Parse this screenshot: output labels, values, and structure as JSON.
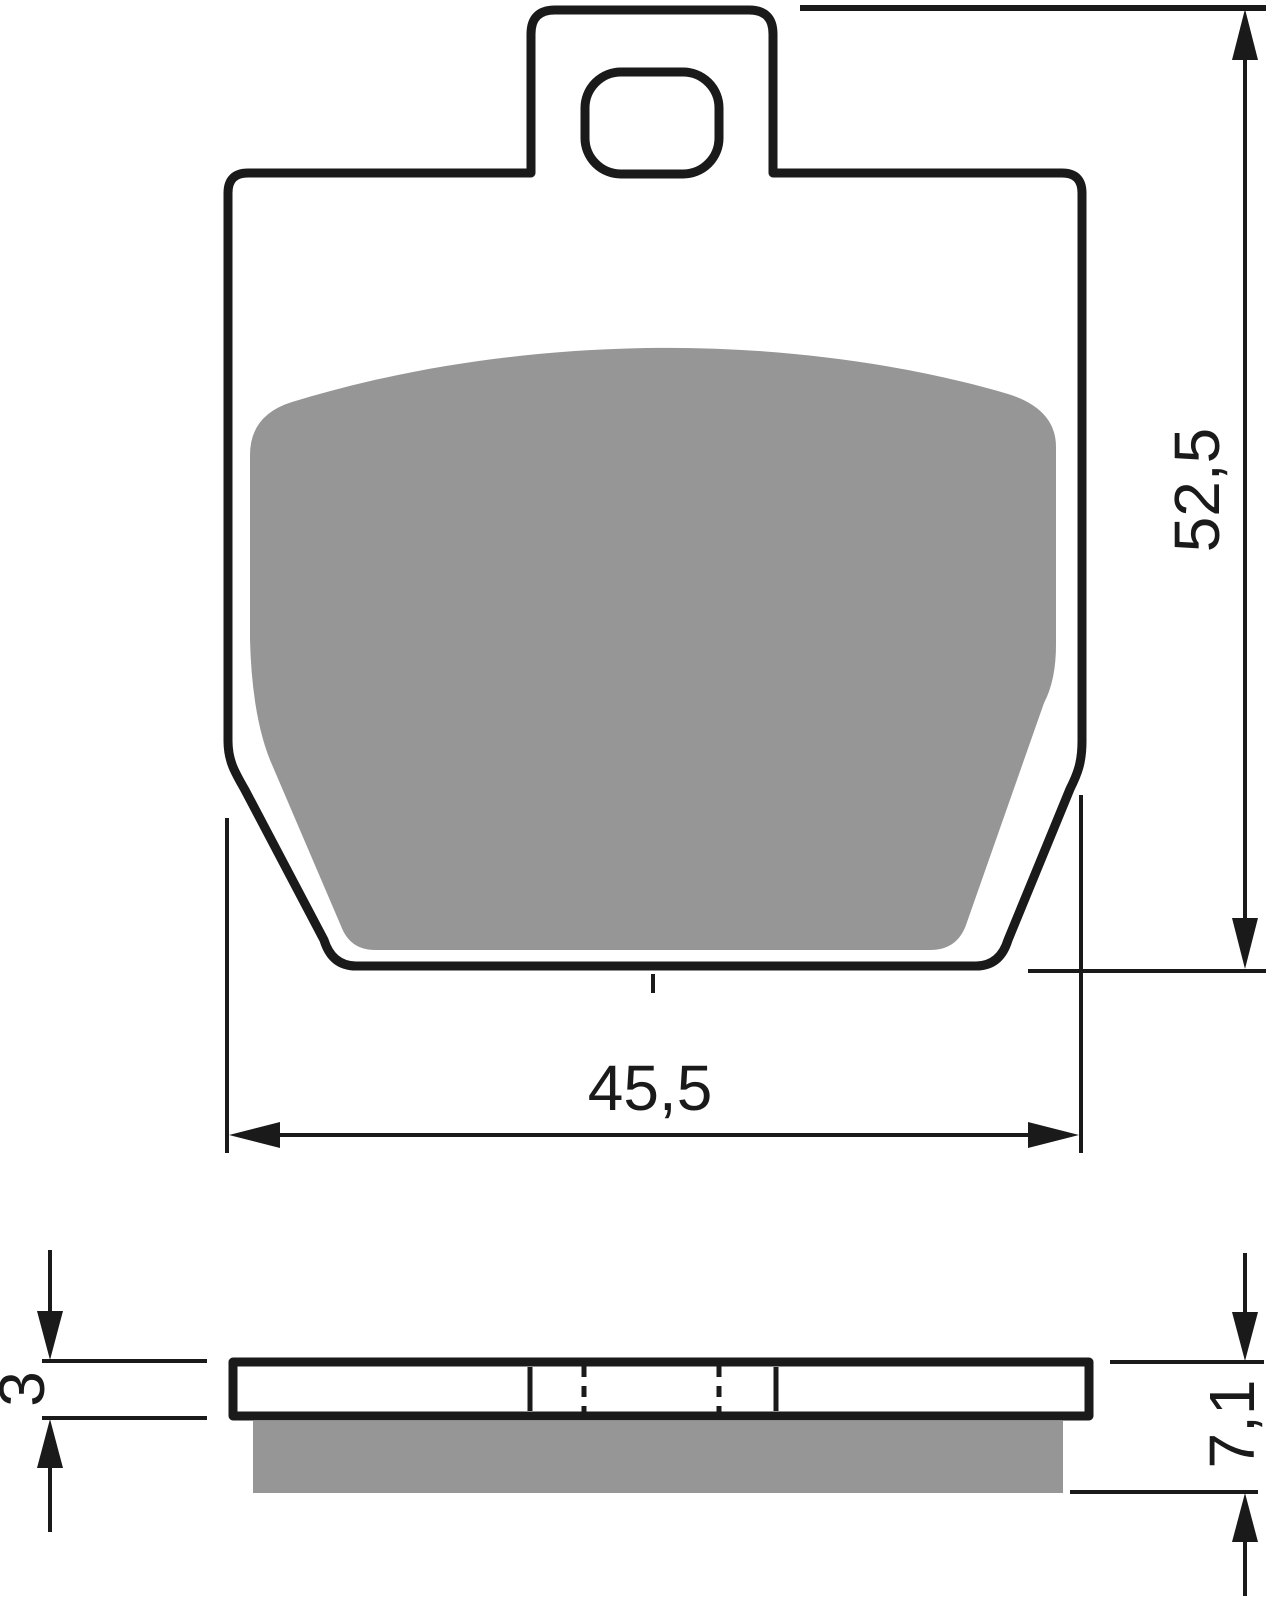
{
  "drawing": {
    "subject": "brake-pad-technical-drawing",
    "views": {
      "front_view": "pad-outline-with-tab-hole-and-friction-material",
      "side_view": "backplate-and-friction-material-profile"
    },
    "dimensions": {
      "pad_height": {
        "label": "52,5"
      },
      "pad_width": {
        "label": "45,5"
      },
      "backplate_thickness": {
        "label": "3"
      },
      "total_thickness": {
        "label": "7,1"
      }
    },
    "colors": {
      "line": "#1a1a1a",
      "friction_material": "#969696",
      "background": "#ffffff"
    }
  }
}
